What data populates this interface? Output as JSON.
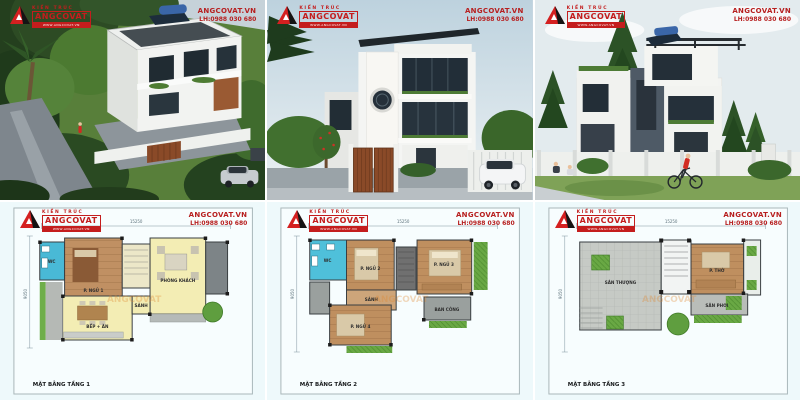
{
  "brand": {
    "logo_small_text": "KIẾN TRÚC",
    "logo_name": "ANGCOVAT",
    "logo_tagline": "WWW.ANGCOVAT.VN",
    "website": "ANGCOVAT.VN",
    "hotline": "LH:0988 030 680",
    "accent_red": "#c41d1d"
  },
  "watermark": "ANGCOVAT",
  "plans": [
    {
      "title": "MẶT BẰNG TẦNG 1",
      "dim_width": "15250",
      "dim_height": "9050",
      "rooms": {
        "wc": "WC",
        "bedroom1": "P. NGỦ 1",
        "living": "PHÒNG KHÁCH",
        "kitchen": "BẾP + ĂN",
        "porch": "SẢNH"
      }
    },
    {
      "title": "MẶT BẰNG TẦNG 2",
      "dim_width": "15250",
      "dim_height": "9050",
      "rooms": {
        "wc": "WC",
        "bedroom2": "P. NGỦ 2",
        "bedroom3": "P. NGỦ 3",
        "bedroom4": "P. NGỦ 4",
        "hall": "SẢNH",
        "balcony": "BAN CÔNG"
      }
    },
    {
      "title": "MẶT BẰNG TẦNG 3",
      "dim_width": "15250",
      "dim_height": "9050",
      "rooms": {
        "terrace": "SÂN THƯỢNG",
        "worship": "P. THỜ",
        "yard": "SÂN PHƠI"
      }
    }
  ]
}
